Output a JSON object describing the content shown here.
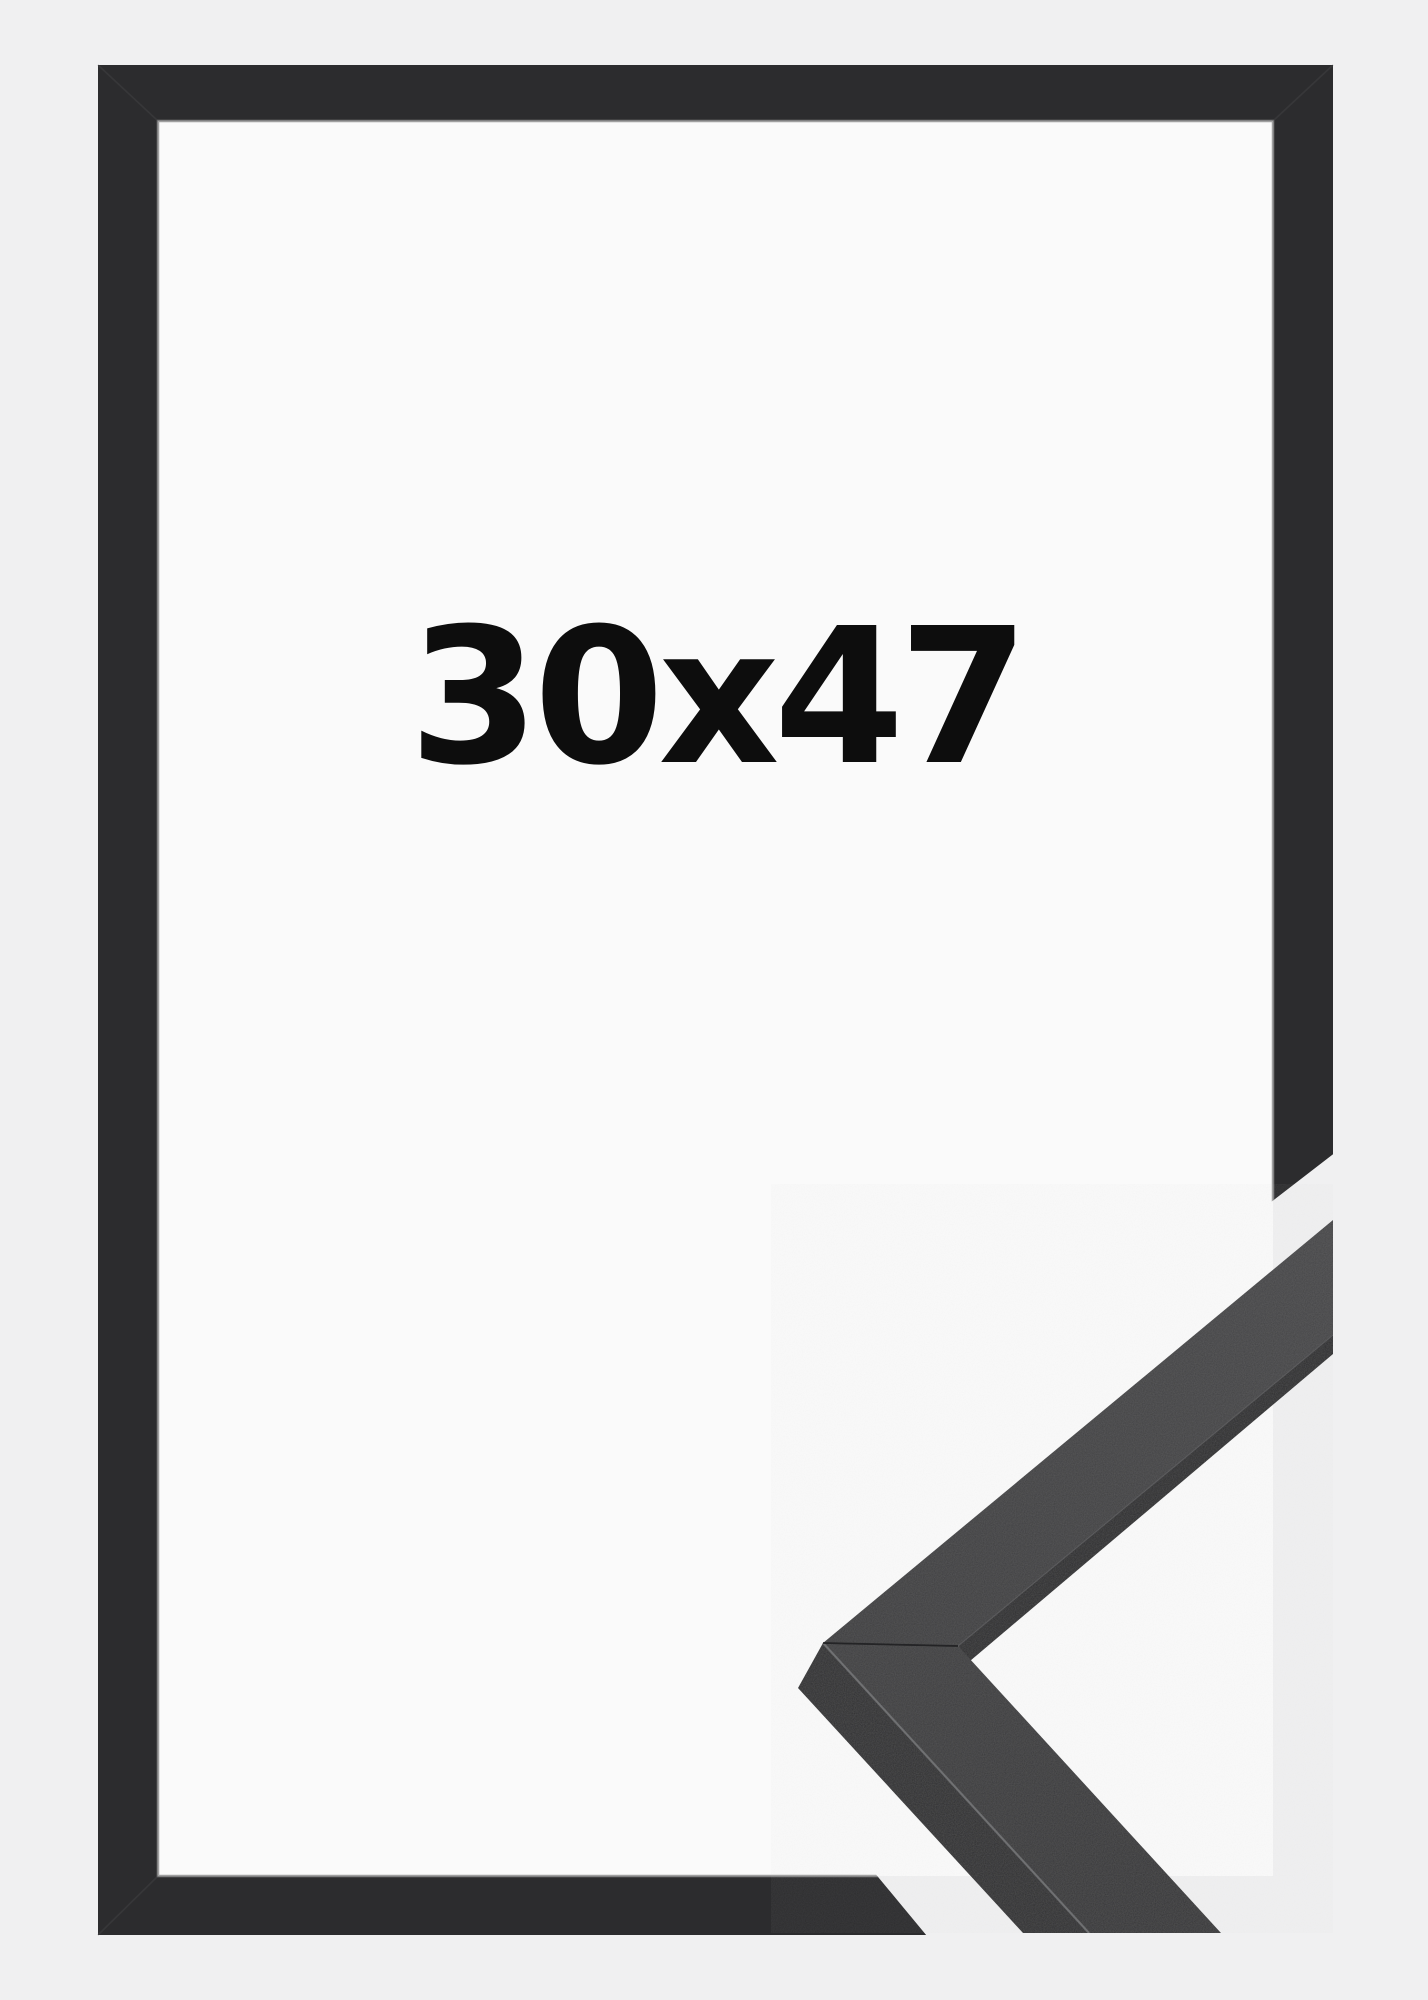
{
  "product_image": {
    "size_label": "30x47",
    "description": "Black picture frame product photo with corner moulding close-up"
  },
  "colors": {
    "page_background": "#f0f0f1",
    "inner_background": "#fafafa",
    "frame": "#2c2c2e",
    "inner_bevel_highlight": "#8f8f8f",
    "moulding_face_upper": "#3f3f41",
    "moulding_face_lower": "#39393b",
    "moulding_side": "#2b2b2d",
    "moulding_edge_strip": "#28282a",
    "edge_highlight": "#7a7b7d",
    "miter_seam": "#1e1e20",
    "label_text": "#0d0d0d"
  }
}
